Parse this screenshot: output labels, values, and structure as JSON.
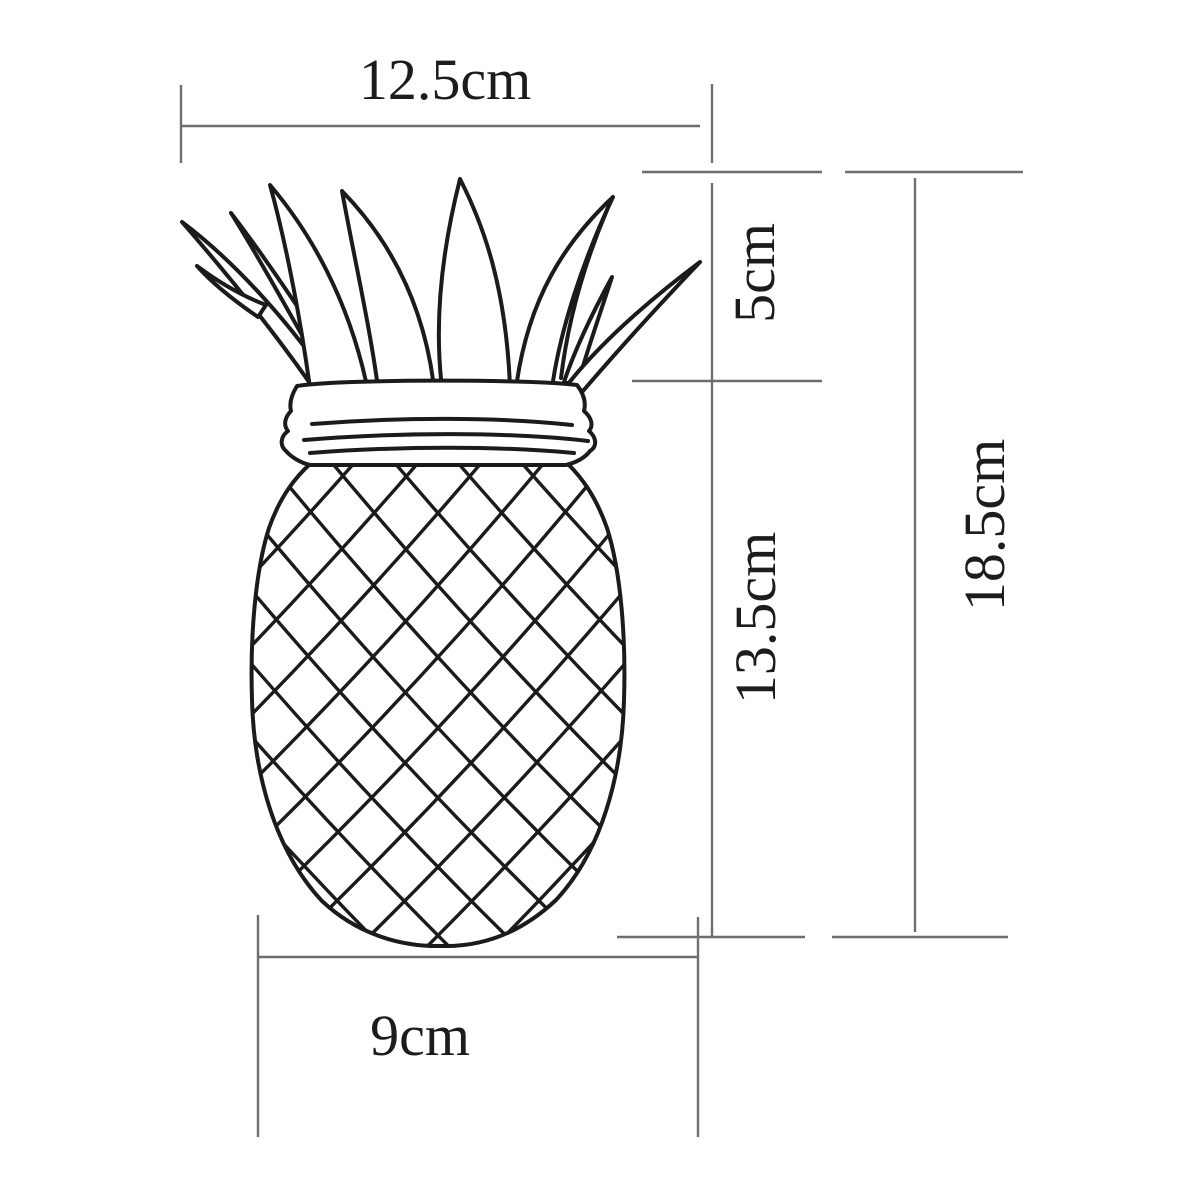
{
  "diagram": {
    "type": "product-dimension-drawing",
    "subject": "pineapple-jar-line-art",
    "colors": {
      "background": "#ffffff",
      "drawing_line": "#1b1b1b",
      "dimension_line": "#6f6f6f",
      "label_text": "#1c1c1c"
    },
    "unit": "cm",
    "dimensions": {
      "top_width": "12.5cm",
      "crown_height": "5cm",
      "body_height": "13.5cm",
      "total_height": "18.5cm",
      "base_width": "9cm"
    }
  }
}
